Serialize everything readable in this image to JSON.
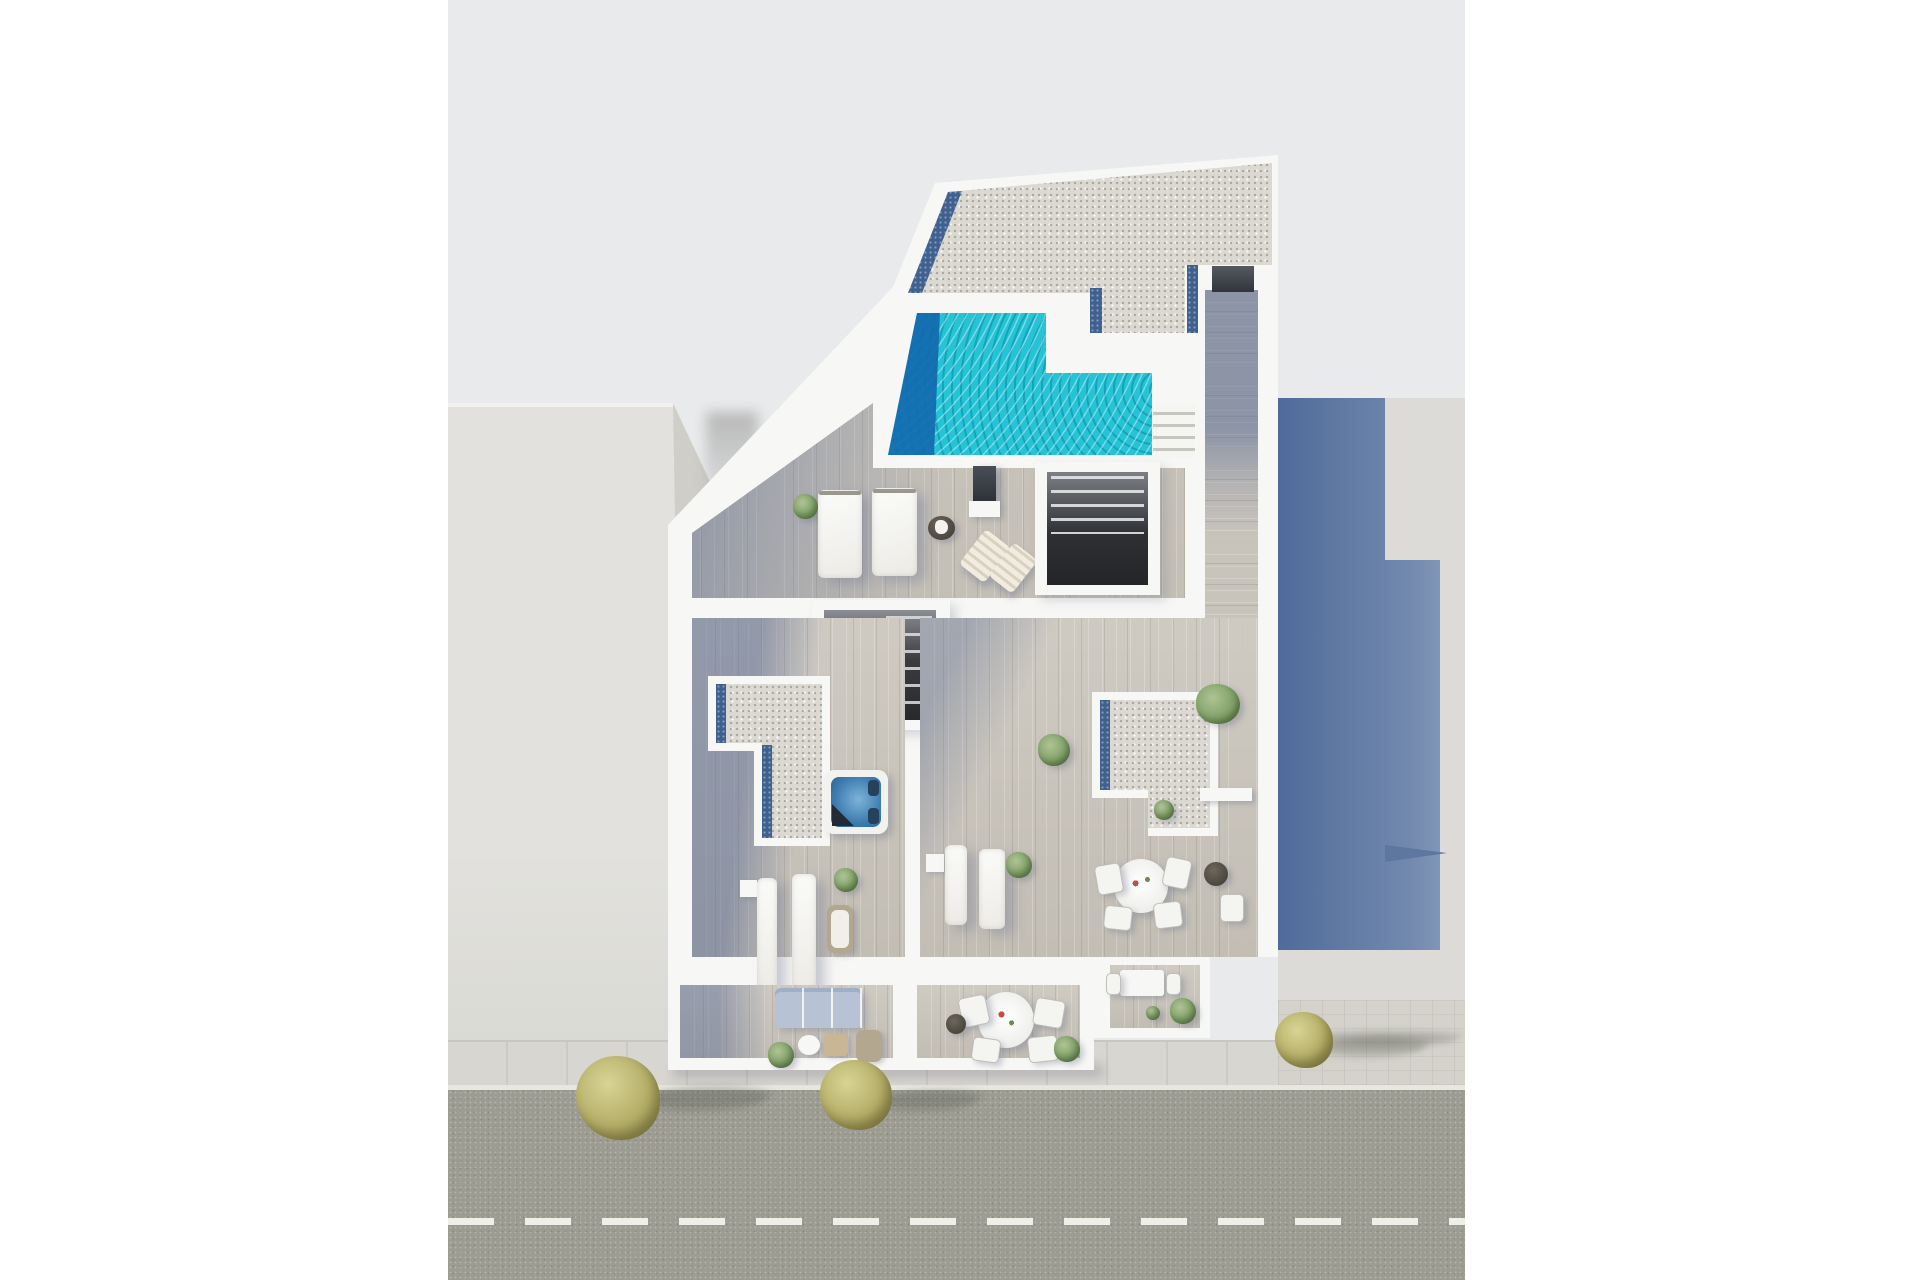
{
  "scene": {
    "type": "aerial-3d-architectural-render",
    "description": "Top-down 3D rendering of a modern apartment building rooftop and upper-floor terraces beside a street",
    "palette": {
      "page_bg": "#ffffff",
      "backdrop": "#e9eaec",
      "building_white": "#f7f7f5",
      "left_building": "#e2e1dd",
      "left_building_bevel": "#cfcec8",
      "right_ground": "#dcdbd7",
      "cast_shadow_dark": "#4f6b9b",
      "cast_shadow_light": "#8ba0bf",
      "gravel": "#dcd9d2",
      "glass_strip": "#40608f",
      "pool_turquoise": "#24c3d5",
      "pool_deep": "#0e5fa6",
      "wood": "#c9c4bb",
      "wood_shadow": "rgba(92,109,148,0.52)",
      "street": "#9c9c92",
      "sidewalk": "#d8d6d0",
      "pavers": "#d4d2cb",
      "road_marking": "#efefe9",
      "tree": "#b3ad67",
      "plant": "#7fa066",
      "plant_light": "#aec394",
      "hot_tub_water": "#3e7cb0",
      "sofa_blue": "#b7c3d4",
      "stair_dark": "#2e3034",
      "wicker": "#b3a790"
    },
    "objects": {
      "rooftop": [
        "gravel-roof-with-solar-glass-strips",
        "swimming-pool",
        "pool-stairs",
        "sun-deck"
      ],
      "pool": {
        "shape": "L-shaped",
        "deep_end_side": "left"
      },
      "upper_deck_items": [
        "double-sunbed",
        "double-sunbed",
        "green-bush",
        "wicker-side-table",
        "privacy-screen",
        "folding-deck-chair",
        "folding-deck-chair",
        "stairwell-opening",
        "stairwell-opening"
      ],
      "mid_terraces_items": [
        "hot-tub",
        "gravel-roof-left",
        "gravel-roof-right",
        "sun-lounger",
        "sun-lounger",
        "sun-lounger",
        "sun-lounger",
        "round-dining-table-4-chairs",
        "side-tables",
        "potted-plants"
      ],
      "lower_balconies_items": [
        "blue-sofa",
        "coffee-tables",
        "wicker-chair",
        "round-dining-table-4-chairs",
        "small-dining-table-2-chairs",
        "potted-plants"
      ],
      "street": {
        "lane_marking": "white-dashed-center-line",
        "curb_line": "solid-white",
        "trees_on_sidewalk": 3
      },
      "neighbors": [
        "flat-grey-building-left",
        "grey-building-right-with-cast-shadow"
      ]
    }
  }
}
